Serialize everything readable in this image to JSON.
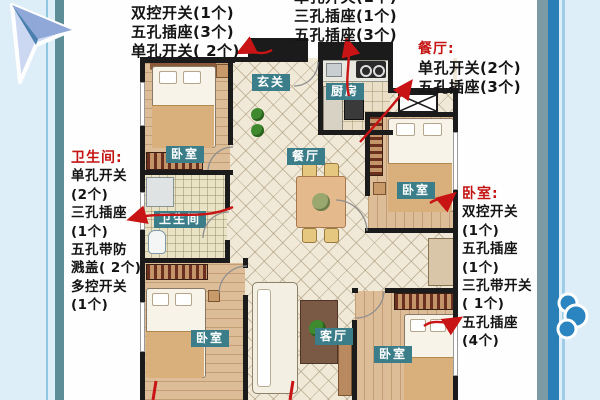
{
  "title": "apartment floor plan with electrical switch and socket count annotations",
  "colors": {
    "frame_bg": "#ddeef8",
    "frame_teal_stripe": "#5d8e97",
    "frame_blue_stripe": "#2b7fb7",
    "frame_gray_stripe": "#7b9aa4",
    "page_bg": "#fefefe",
    "annotation_red": "#c41414",
    "annotation_black": "#141414",
    "room_label_bg": "#3b7e8a",
    "room_label_text": "#ffffff",
    "wall": "#1b1b1b",
    "arrow_red": "#c81414"
  },
  "annotations": {
    "top_left": {
      "header": "卧室:",
      "items": [
        "双控开关(1个)",
        "五孔插座(3个)",
        "单孔开关( 2个)"
      ]
    },
    "top_middle": {
      "clipped_item": "单孔开关(1个)",
      "items": [
        "三孔插座(1个)",
        "五孔插座(3个)"
      ]
    },
    "dining": {
      "header": "餐厅:",
      "items": [
        "单孔开关(2个)",
        "五孔插座(3个)"
      ]
    },
    "bathroom": {
      "header": "卫生间:",
      "items": [
        "单孔开关",
        "(2个)",
        "三孔插座",
        "(1个)",
        "五孔带防",
        "溅盖( 2个)",
        "多控开关",
        "(1个)"
      ]
    },
    "bedroom_right": {
      "header": "卧室:",
      "items": [
        "双控开关",
        "(1个)",
        "五孔插座",
        "(1个)",
        "三孔带开关",
        "( 1个)",
        "五孔插座",
        "(4个)"
      ]
    }
  },
  "plan": {
    "rooms": {
      "entry": "玄关",
      "kitchen": "厨房",
      "dining": "餐厅",
      "bedroom_top_left": "卧室",
      "bathroom": "卫生间",
      "bedroom_right": "卧室",
      "bedroom_bottom_left": "卧室",
      "living": "客厅",
      "bedroom_bottom_right": "卧室"
    }
  }
}
